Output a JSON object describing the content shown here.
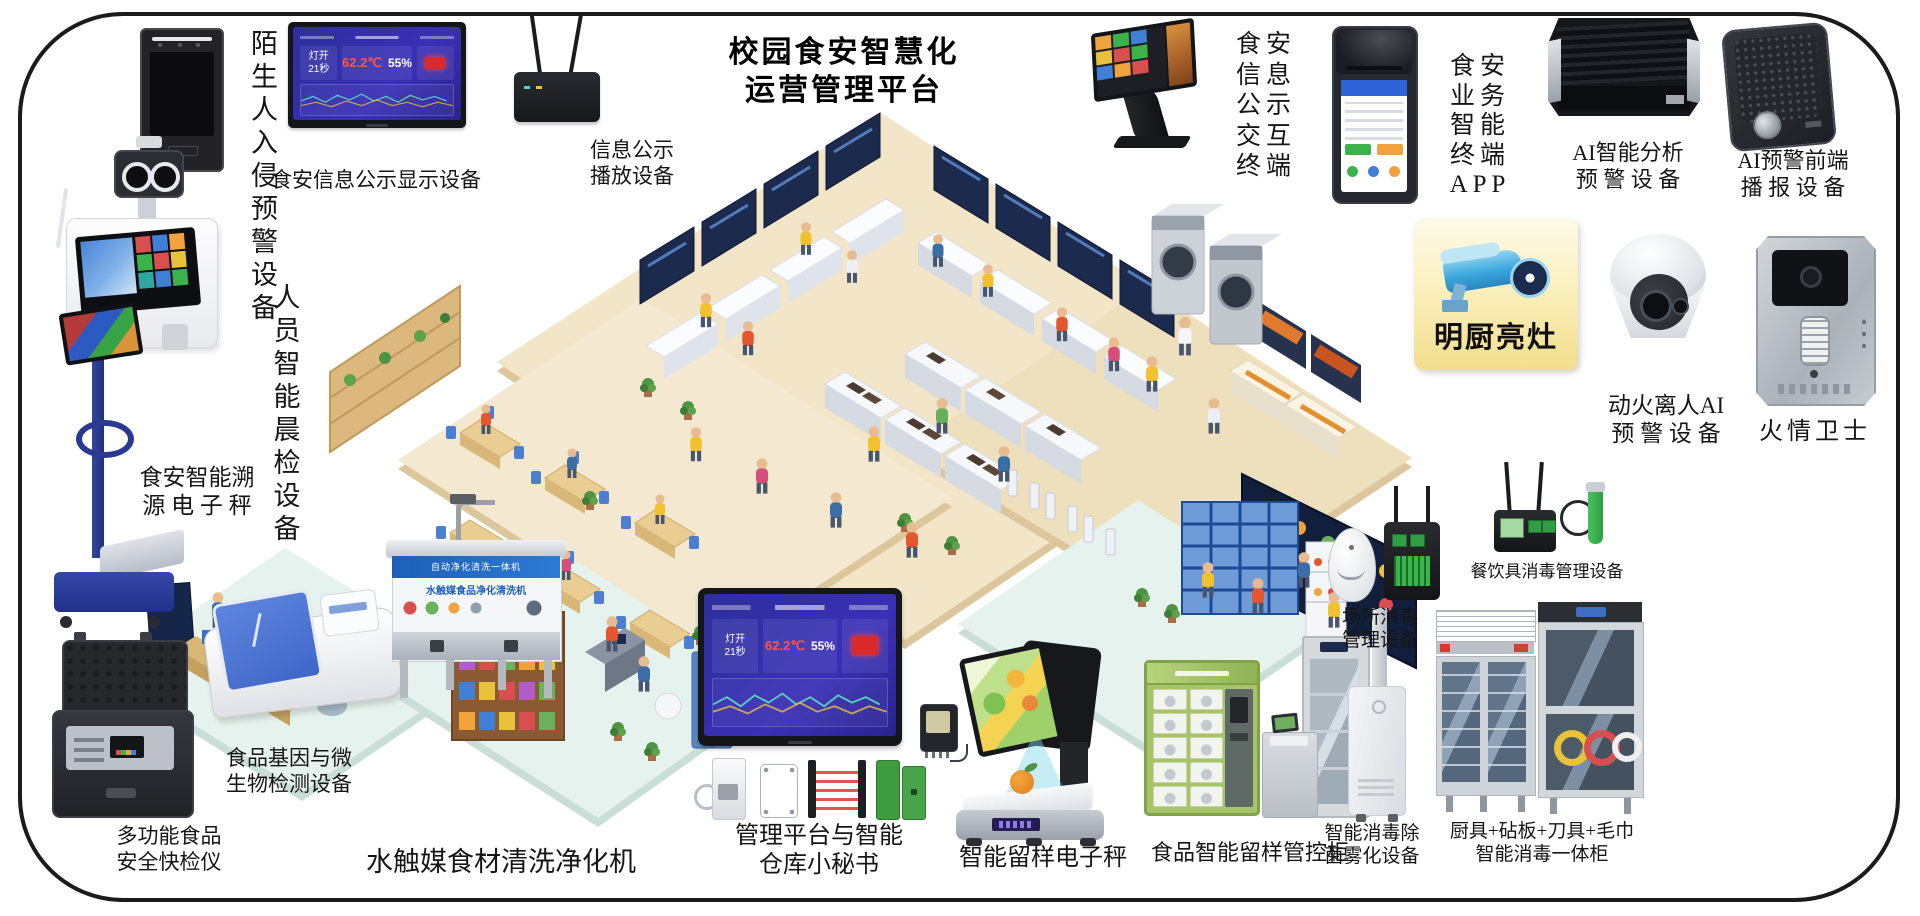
{
  "title": {
    "line1": "校园食安智慧化",
    "line2": "运营管理平台"
  },
  "devices": {
    "stranger_alarm": {
      "label": "陌生\n人入\n侵预\n警设\n备"
    },
    "info_display": {
      "label": "食安信息公示显示设备"
    },
    "info_player": {
      "label": "信息公示\n播放设备"
    },
    "morning_check": {
      "label": "人员\n智能\n晨检\n设备"
    },
    "trace_scale": {
      "label": "食安智能溯\n源 电 子 秤"
    },
    "rapid_tester": {
      "label": "多功能食品\n安全快检仪"
    },
    "gene_detector": {
      "label": "食品基因与微\n生物检测设备"
    },
    "washer": {
      "label": "水触媒食材清洗净化机"
    },
    "mgmt_platform": {
      "label": "管理平台与智能\n仓库小秘书"
    },
    "sample_scale": {
      "label": "智能留样电子秤"
    },
    "sample_cabinet": {
      "label": "食品智能留样管控柜"
    },
    "fogger": {
      "label": "智能消毒除\n菌雾化设备"
    },
    "disinfect_cabinet": {
      "label": "厨具+砧板+刀具+毛巾\n智能消毒一体柜"
    },
    "venue_disinfect": {
      "label": "场所消毒\n管理设备"
    },
    "tableware_disinfect": {
      "label": "餐饮具消毒管理设备"
    },
    "fire_ai": {
      "label": "动火离人AI\n预 警 设 备"
    },
    "fire_guard": {
      "label": "火情卫士"
    },
    "ai_analysis": {
      "label": "AI智能分析\n预 警 设 备"
    },
    "ai_broadcast": {
      "label": "AI预警前端\n播 报 设 备"
    },
    "kiosk": {
      "label": "食安\n信息\n公示\n交互\n终端"
    },
    "pos_app": {
      "label": "食安\n业务\n智能\n终端\nAPP"
    },
    "mingchu": {
      "label": "明厨亮灶"
    }
  },
  "dashboard": {
    "light_label": "灯开",
    "light_value": "21秒",
    "temp": "62.2℃",
    "humidity": "55%"
  },
  "washer_banner": {
    "line1": "自动净化清洗一体机",
    "line2": "水触媒食品净化清洗机"
  },
  "colors": {
    "floor_beige": "#f2e5c8",
    "platform_mint": "#e6f2ed",
    "screen_navy": "#1c2a4e",
    "dash_blue": "#2f2fae",
    "card_yellow": "#f6e49a",
    "camera_blue": "#3aa7dc",
    "alert_red": "#d92b2b",
    "accent_green": "#3ab54a"
  }
}
